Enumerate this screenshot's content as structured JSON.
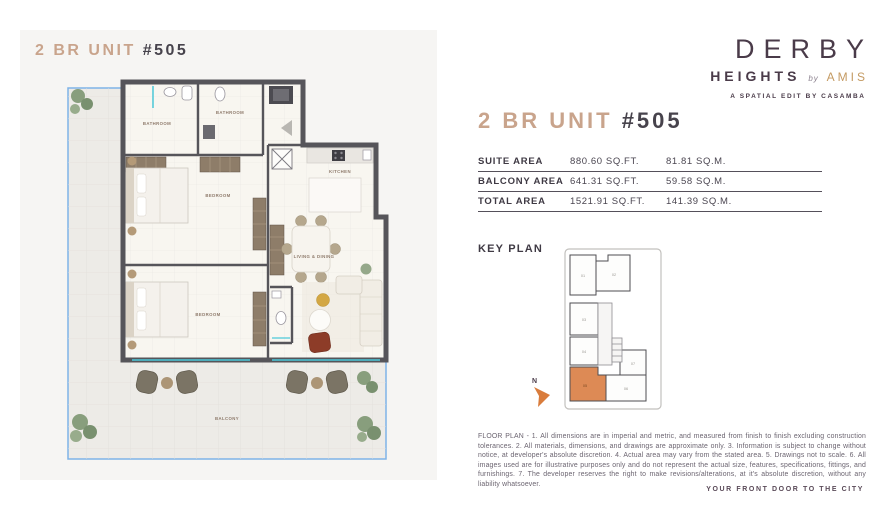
{
  "brand": {
    "name": "DERBY",
    "sub": "HEIGHTS",
    "by": "by",
    "partner": "AMIS",
    "tagline": "A SPATIAL EDIT BY CASAMBA"
  },
  "unit": {
    "title_prefix": "2 BR UNIT",
    "title_number": "#505"
  },
  "area_table": {
    "rows": [
      {
        "label": "SUITE AREA",
        "imperial": "880.60 SQ.FT.",
        "metric": "81.81 SQ.M."
      },
      {
        "label": "BALCONY AREA",
        "imperial": "641.31 SQ.FT.",
        "metric": "59.58 SQ.M."
      },
      {
        "label": "TOTAL AREA",
        "imperial": "1521.91 SQ.FT.",
        "metric": "141.39 SQ.M."
      }
    ]
  },
  "floor_plan": {
    "labels": {
      "bathroom1": "BATHROOM",
      "bathroom2": "BATHROOM",
      "bedroom1": "BEDROOM",
      "bedroom2": "BEDROOM",
      "kitchen": "KITCHEN",
      "living_dining": "LIVING & DINING",
      "balcony": "BALCONY"
    }
  },
  "key_plan": {
    "label": "KEY PLAN",
    "north_label": "N",
    "highlighted_unit": "05",
    "units": [
      "01",
      "02",
      "03",
      "04",
      "05",
      "06",
      "07"
    ]
  },
  "disclaimer": "FLOOR PLAN - 1. All dimensions are in imperial and metric, and measured from finish to finish excluding construction tolerances. 2. All materials, dimensions, and drawings are approximate only. 3. Information is subject to change without notice, at developer's absolute discretion. 4. Actual area may vary from the stated area. 5. Drawings not to scale. 6. All images used are for illustrative purposes only and do not represent the actual size, features, specifications, fittings, and furnishings. 7. The developer reserves the right to make revisions/alterations, at it's absolute discretion, without any liability whatsoever.",
  "footer": "YOUR FRONT DOOR TO THE CITY",
  "colors": {
    "accent_tan": "#c9a48c",
    "brand_gold": "#c49a62",
    "dark_plum": "#4a3b49",
    "key_highlight": "#dd8a55",
    "balcony_blue": "#7fb3e8",
    "wall_gray": "#56555a"
  }
}
